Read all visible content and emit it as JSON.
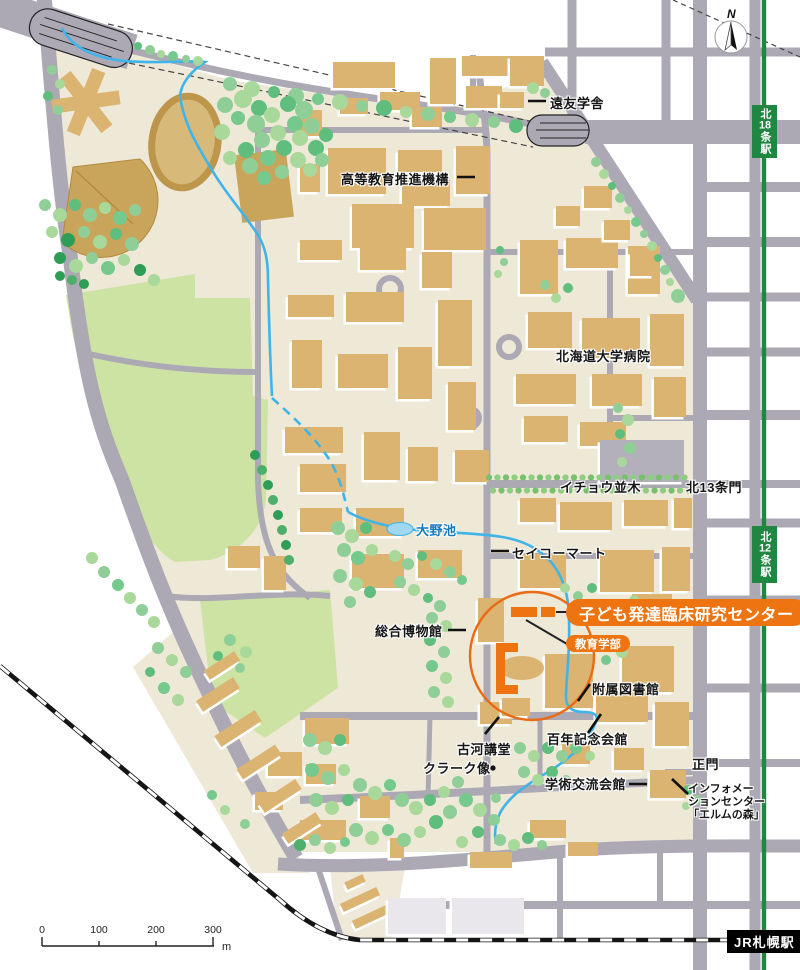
{
  "labels": {
    "enyu": "遠友学舎",
    "koto_kyoiku": "高等教育推進機構",
    "hospital": "北海道大学病院",
    "icho": "イチョウ並木",
    "kita13_gate": "北13条門",
    "oono_pond": "大野池",
    "seicomart": "セイコーマート",
    "museum": "総合博物館",
    "center": "子ども発達臨床研究センター",
    "kyoiku_faculty": "教育学部",
    "library": "附属図書館",
    "hyakunen": "百年記念会館",
    "furukawa": "古河講堂",
    "clark": "クラーク像",
    "gakujutsu": "学術交流会館",
    "main_gate": "正門",
    "info_line1": "インフォメー",
    "info_line2": "ションセンター",
    "info_line3": "「エルムの森」"
  },
  "stations": {
    "kita18": {
      "prefix": "北",
      "number": "18",
      "suffix": "条駅"
    },
    "kita12": {
      "prefix": "北",
      "number": "12",
      "suffix": "条駅"
    },
    "sapporo": "JR札幌駅"
  },
  "scale_bar": {
    "t0": "0",
    "t100": "100",
    "t200": "200",
    "t300": "300",
    "unit": "m"
  },
  "compass": {
    "north": "N"
  },
  "colors": {
    "highlight": "#ED7411",
    "highlight_stroke": "#EB6A14",
    "campus": "#EEE8D7",
    "road": "#ACA9B5",
    "building": "#DBB471",
    "field_green": "#CDE3A4",
    "sports_tan": "#C9A45B",
    "stream": "#3FB4E8",
    "subway_green": "#1F8742",
    "rail_black": "#151515"
  }
}
